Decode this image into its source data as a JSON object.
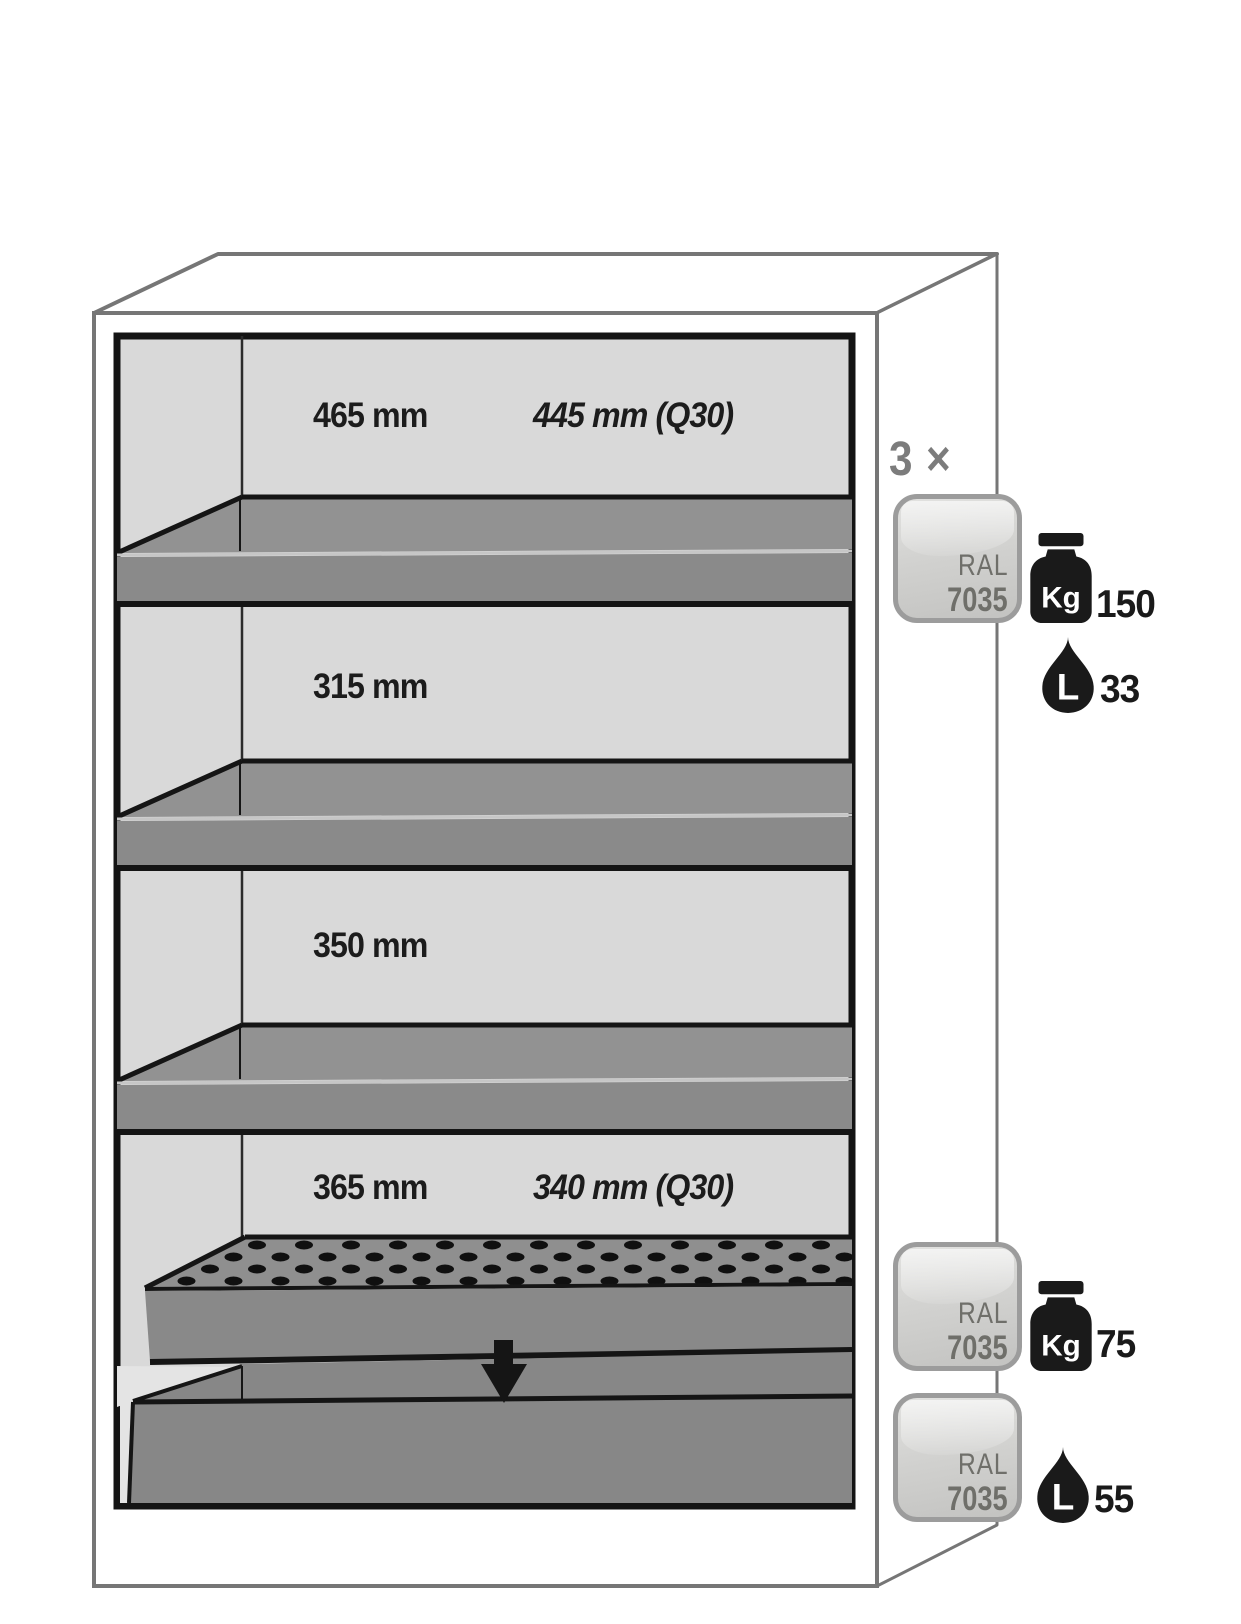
{
  "compartments": [
    {
      "depth_label": "465 mm",
      "depth_label_q30": "445 mm (Q30)"
    },
    {
      "depth_label": "315 mm"
    },
    {
      "depth_label": "350 mm"
    },
    {
      "depth_label": "365 mm",
      "depth_label_q30": "340 mm (Q30)"
    }
  ],
  "right_column": {
    "count_label": "3 ×",
    "top_group": {
      "badge": {
        "line1": "RAL",
        "line2": "7035"
      },
      "weight": {
        "unit": "Kg",
        "value": "150"
      },
      "volume": {
        "unit": "L",
        "value": "33"
      }
    },
    "insert_group": {
      "badge": {
        "line1": "RAL",
        "line2": "7035"
      },
      "weight": {
        "unit": "Kg",
        "value": "75"
      }
    },
    "sump_group": {
      "badge": {
        "line1": "RAL",
        "line2": "7035"
      },
      "volume": {
        "unit": "L",
        "value": "55"
      }
    }
  },
  "colors": {
    "wall_gray": "#d9d9d9",
    "shelf_top_gray": "#929292",
    "shelf_front_gray": "#8a8a8a",
    "outline_black": "#151515",
    "cabinet_line_gray": "#767676",
    "count_label_gray": "#7c7c7c",
    "badge_text_gray": "#6f6f6a",
    "ink_black": "#1a1a1a"
  }
}
